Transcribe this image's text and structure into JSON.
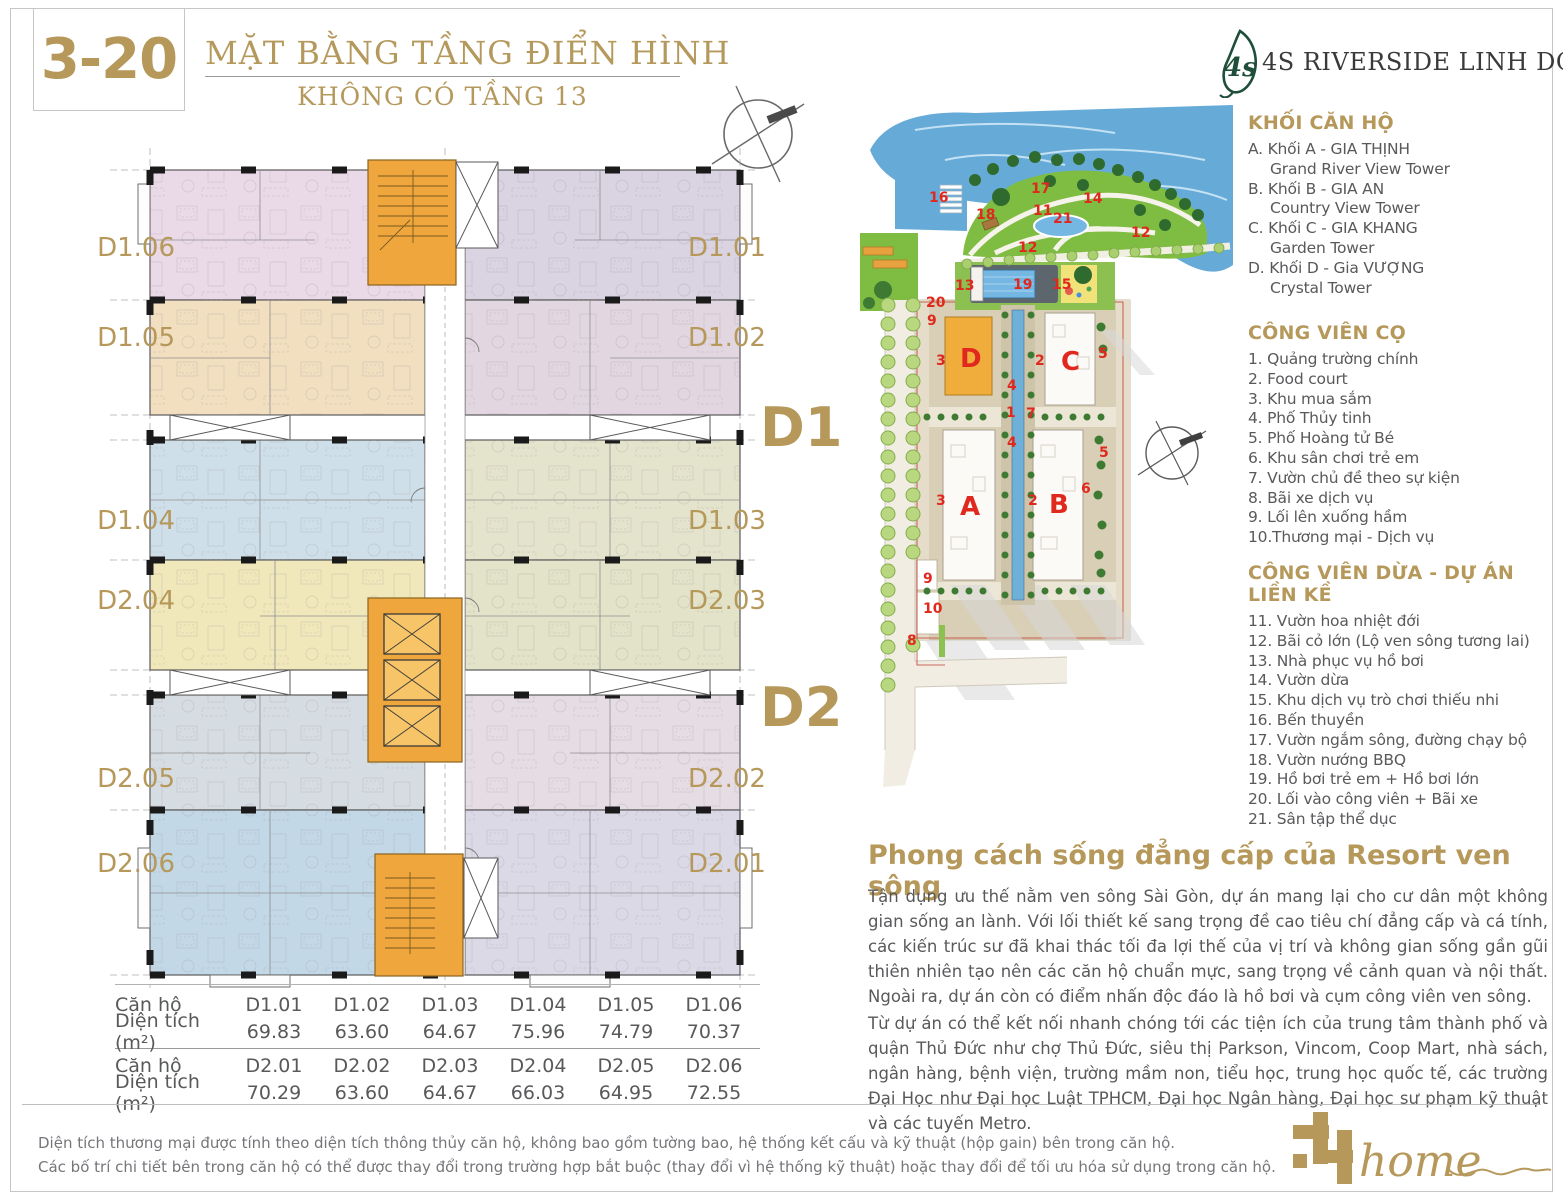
{
  "page": {
    "code": "3-20",
    "title": "MẶT BẰNG TẦNG ĐIỂN HÌNH",
    "subtitle": "KHÔNG CÓ TẦNG 13",
    "brand": "4S RIVERSIDE LINH DONG"
  },
  "colors": {
    "gold": "#b5985a",
    "marker_red": "#e0281e",
    "leaf_green": "#1f4f3a",
    "body_text": "#58595b",
    "core_orange": "#efa63d",
    "park_green": "#7fbc42",
    "river_blue": "#66abd8"
  },
  "floor_plan": {
    "big_labels": [
      "D1",
      "D2"
    ],
    "left_units": [
      "D1.06",
      "D1.05",
      "D1.04",
      "D2.04",
      "D2.05",
      "D2.06"
    ],
    "right_units": [
      "D1.01",
      "D1.02",
      "D1.03",
      "D2.03",
      "D2.02",
      "D2.01"
    ]
  },
  "site_map": {
    "buildings": [
      "D",
      "C",
      "A",
      "B"
    ],
    "markers": [
      "16",
      "18",
      "17",
      "11",
      "21",
      "14",
      "12",
      "12",
      "13",
      "19",
      "15",
      "20",
      "9",
      "3",
      "2",
      "5",
      "4",
      "1",
      "7",
      "4",
      "5",
      "6",
      "3",
      "2",
      "9",
      "10",
      "8"
    ]
  },
  "legend": {
    "blocks": {
      "header": "KHỐI CĂN HỘ",
      "lines": [
        "A. Khối A - GIA THỊNH",
        "Grand River View Tower",
        "B. Khối B - GIA AN",
        "Country View Tower",
        "C. Khối C - GIA KHANG",
        "Garden Tower",
        "D. Khối D - Gia VƯỢNG",
        "Crystal Tower"
      ]
    },
    "palm": {
      "header": "CÔNG VIÊN CỌ",
      "items": [
        "1. Quảng trường chính",
        "2. Food court",
        "3. Khu mua sắm",
        "4. Phố Thủy tinh",
        "5. Phố Hoàng tử Bé",
        "6. Khu sân chơi trẻ em",
        "7. Vườn chủ đề theo sự kiện",
        "8. Bãi xe dịch vụ",
        "9. Lối lên xuống hầm",
        "10.Thương mại - Dịch vụ"
      ]
    },
    "coconut": {
      "header": "CÔNG VIÊN DỪA - DỰ ÁN LIỀN KỀ",
      "items": [
        "11. Vườn hoa nhiệt đới",
        "12. Bãi cỏ lớn (Lộ ven sông tương lai)",
        "13. Nhà phục vụ hồ bơi",
        "14. Vườn dừa",
        "15. Khu dịch vụ trò chơi thiếu nhi",
        "16. Bến thuyền",
        "17. Vườn ngắm sông, đường chạy bộ",
        "18. Vườn nướng BBQ",
        "19. Hồ bơi trẻ em + Hồ bơi lớn",
        "20. Lối vào công viên + Bãi xe",
        "21. Sân tập thể dục"
      ]
    }
  },
  "promo": {
    "heading": "Phong cách sống đẳng cấp của Resort ven sông",
    "p1": "Tận dụng ưu thế nằm ven sông Sài Gòn, dự án mang lại cho cư dân một không gian sống an lành. Với lối thiết kế sang trọng đề cao tiêu chí đẳng cấp và cá tính, các kiến trúc sư đã khai thác tối đa lợi thế của vị trí và không gian sống gần gũi thiên nhiên tạo nên các căn hộ chuẩn mực, sang trọng về cảnh quan và nội thất. Ngoài ra, dự án còn có điểm nhấn độc đáo là hồ bơi và cụm công viên ven sông.",
    "p2": "Từ dự án có thể kết nối nhanh chóng tới các tiện ích của trung tâm thành phố và quận Thủ Đức như chợ Thủ Đức, siêu thị Parkson, Vincom, Coop Mart, nhà sách, ngân hàng, bệnh viện, trường mầm non, tiểu học, trung học quốc tế, các trường Đại Học như Đại học Luật TPHCM, Đại học Ngân hàng, Đại học sư phạm kỹ thuật và các tuyến Metro."
  },
  "area_table": {
    "unit_label": "Căn hộ",
    "area_label": "Diện tích (m²)",
    "d1": {
      "units": [
        "D1.01",
        "D1.02",
        "D1.03",
        "D1.04",
        "D1.05",
        "D1.06"
      ],
      "areas": [
        "69.83",
        "63.60",
        "64.67",
        "75.96",
        "74.79",
        "70.37"
      ]
    },
    "d2": {
      "units": [
        "D2.01",
        "D2.02",
        "D2.03",
        "D2.04",
        "D2.05",
        "D2.06"
      ],
      "areas": [
        "70.29",
        "63.60",
        "64.67",
        "66.03",
        "64.95",
        "72.55"
      ]
    }
  },
  "footer": {
    "line1": "Diện tích thương mại được tính theo diện tích thông thủy căn hộ, không bao gồm tường bao, hệ thống kết cấu và kỹ thuật (hộp gain) bên trong căn hộ.",
    "line2": "Các bố trí chi tiết bên trong căn hộ có thể được thay đổi trong trường hợp bắt buộc (thay đổi vì hệ thống kỹ thuật) hoặc thay đổi để tối ưu hóa sử dụng trong căn hộ."
  },
  "home_logo": {
    "text": "home"
  }
}
